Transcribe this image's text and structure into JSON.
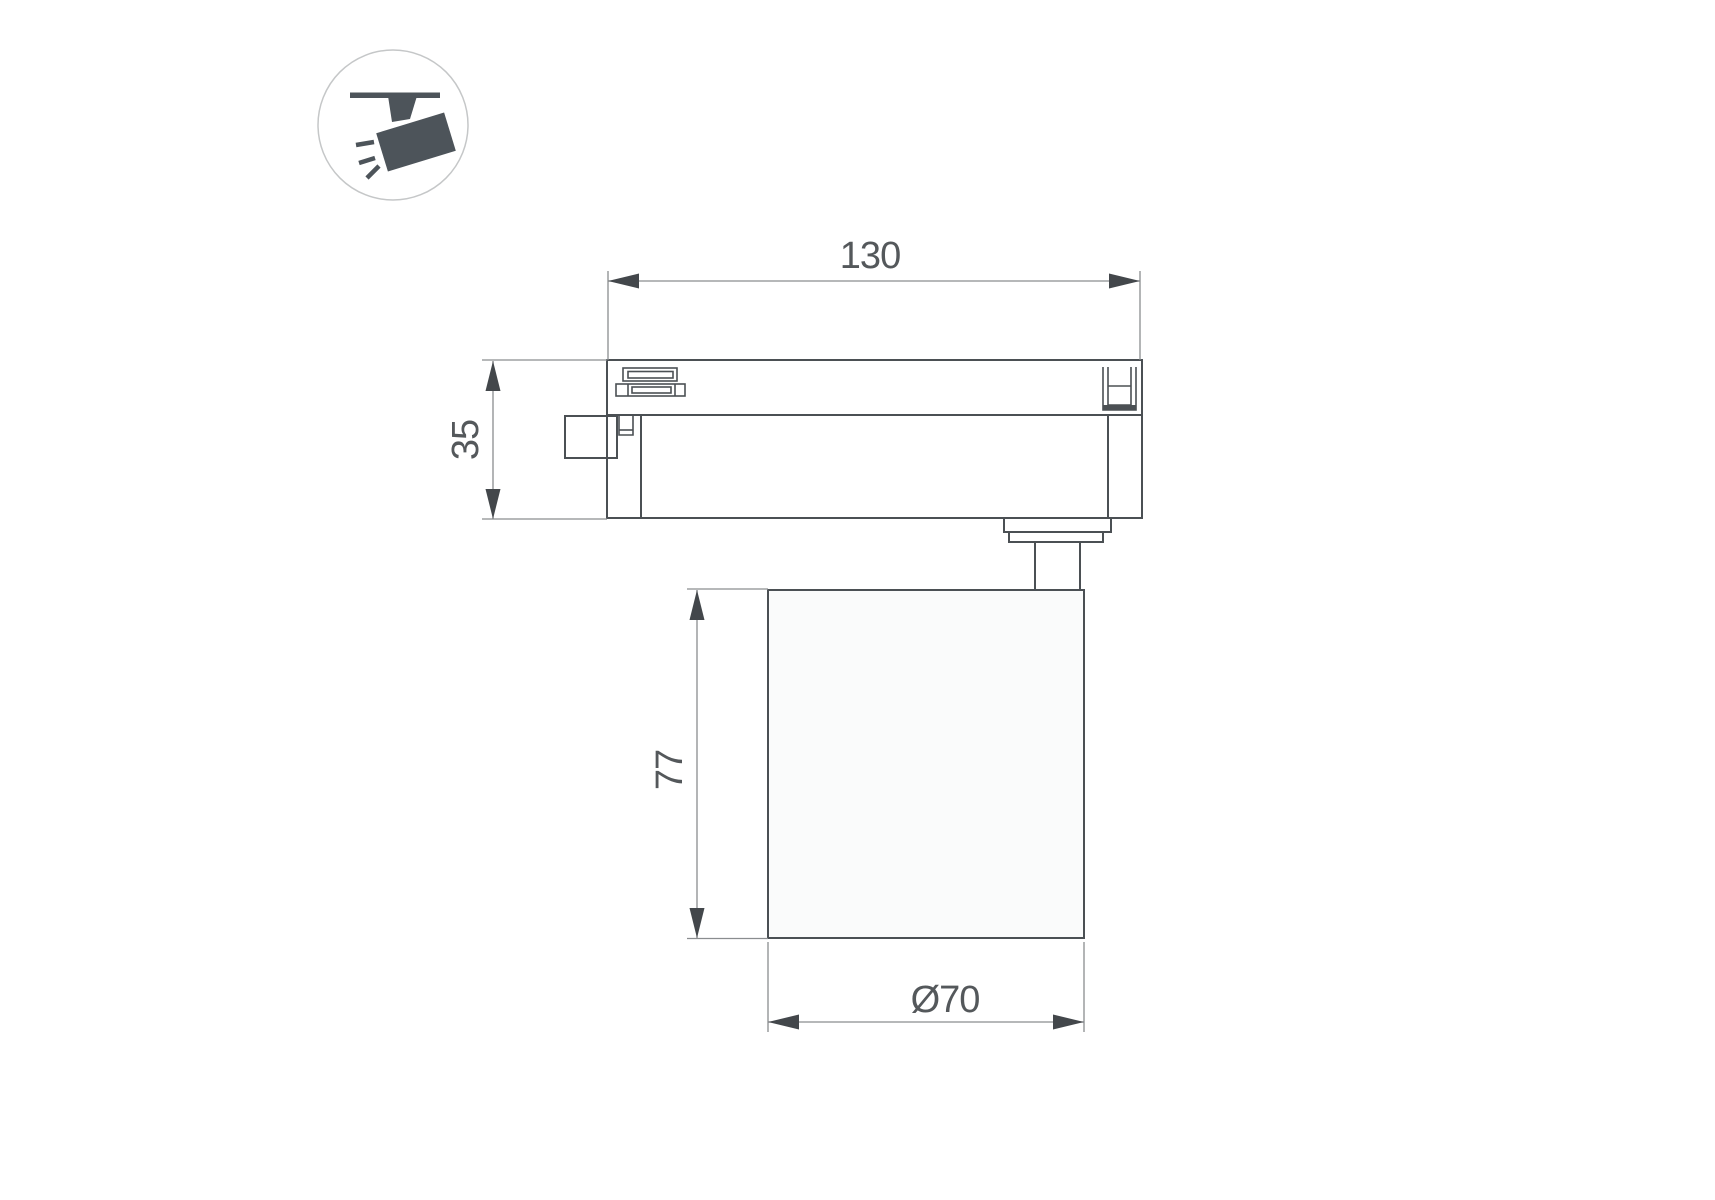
{
  "icon": {
    "name": "track-light-icon"
  },
  "drawing": {
    "dim_width": "130",
    "dim_height": "35",
    "dim_body_height": "77",
    "dim_body_diameter": "Ø70"
  },
  "colors": {
    "background": "#ffffff",
    "object_line": "#4b5054",
    "dimension_line": "#8a8d8f",
    "dimension_arrow": "#43474b",
    "text": "#54585b",
    "icon": "#4d545a"
  }
}
